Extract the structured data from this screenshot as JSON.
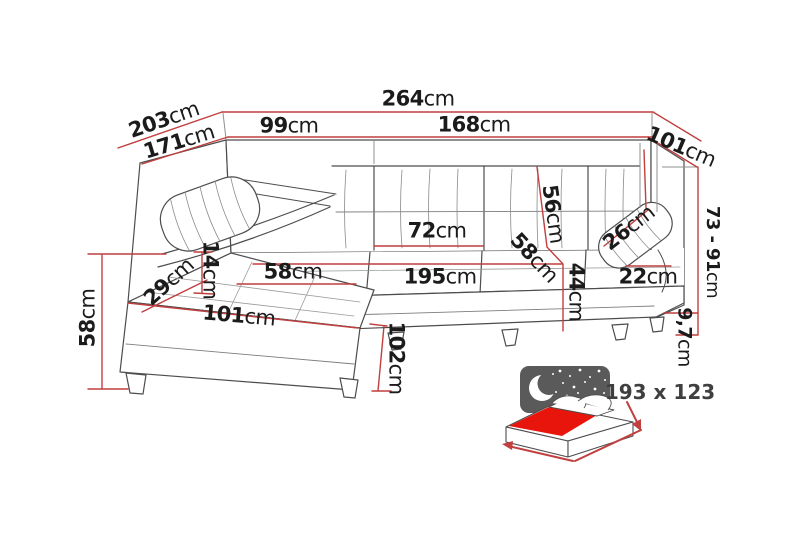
{
  "diagram": {
    "type": "corner-sofa-dimension-diagram",
    "unit": "cm",
    "dims": {
      "total_width": {
        "v": "264",
        "u": "cm"
      },
      "back_left_section": {
        "v": "99",
        "u": "cm"
      },
      "back_right_section": {
        "v": "168",
        "u": "cm"
      },
      "depth_outer": {
        "v": "203",
        "u": "cm"
      },
      "depth_inner": {
        "v": "171",
        "u": "cm"
      },
      "side_width": {
        "v": "101",
        "u": "cm"
      },
      "height_adjustable": {
        "v": "73 - 91",
        "u": "cm"
      },
      "leg_height": {
        "v": "9,7",
        "u": "cm"
      },
      "backrest_height": {
        "v": "56",
        "u": "cm"
      },
      "headrest_right": {
        "v": "26",
        "u": "cm"
      },
      "back_cushion": {
        "v": "72",
        "u": "cm"
      },
      "seat_depth_diag": {
        "v": "58",
        "u": "cm"
      },
      "seat_height_front": {
        "v": "44",
        "u": "cm"
      },
      "armrest_right": {
        "v": "22",
        "u": "cm"
      },
      "seat_width": {
        "v": "195",
        "u": "cm"
      },
      "chaise_seat": {
        "v": "58",
        "u": "cm"
      },
      "headrest_left": {
        "v": "14",
        "u": "cm"
      },
      "armrest_left": {
        "v": "29",
        "u": "cm"
      },
      "chaise_front": {
        "v": "101",
        "u": "cm"
      },
      "seat_height_left": {
        "v": "58",
        "u": "cm"
      },
      "chaise_depth": {
        "v": "102",
        "u": "cm"
      }
    },
    "sleeping_area": {
      "size": "193 x 123"
    },
    "icons": {
      "bed_icon": "sofa-bed-sleeping-function-icon",
      "moon_icon": "moon-and-stars-night-icon"
    },
    "colors": {
      "dimension_line": "#c13f3f",
      "sofa_outline": "#4d4d4d",
      "mattress_red": "#e8150d",
      "icon_panel_gray": "#5a5a5a",
      "label_text": "#1b1b1b"
    }
  }
}
